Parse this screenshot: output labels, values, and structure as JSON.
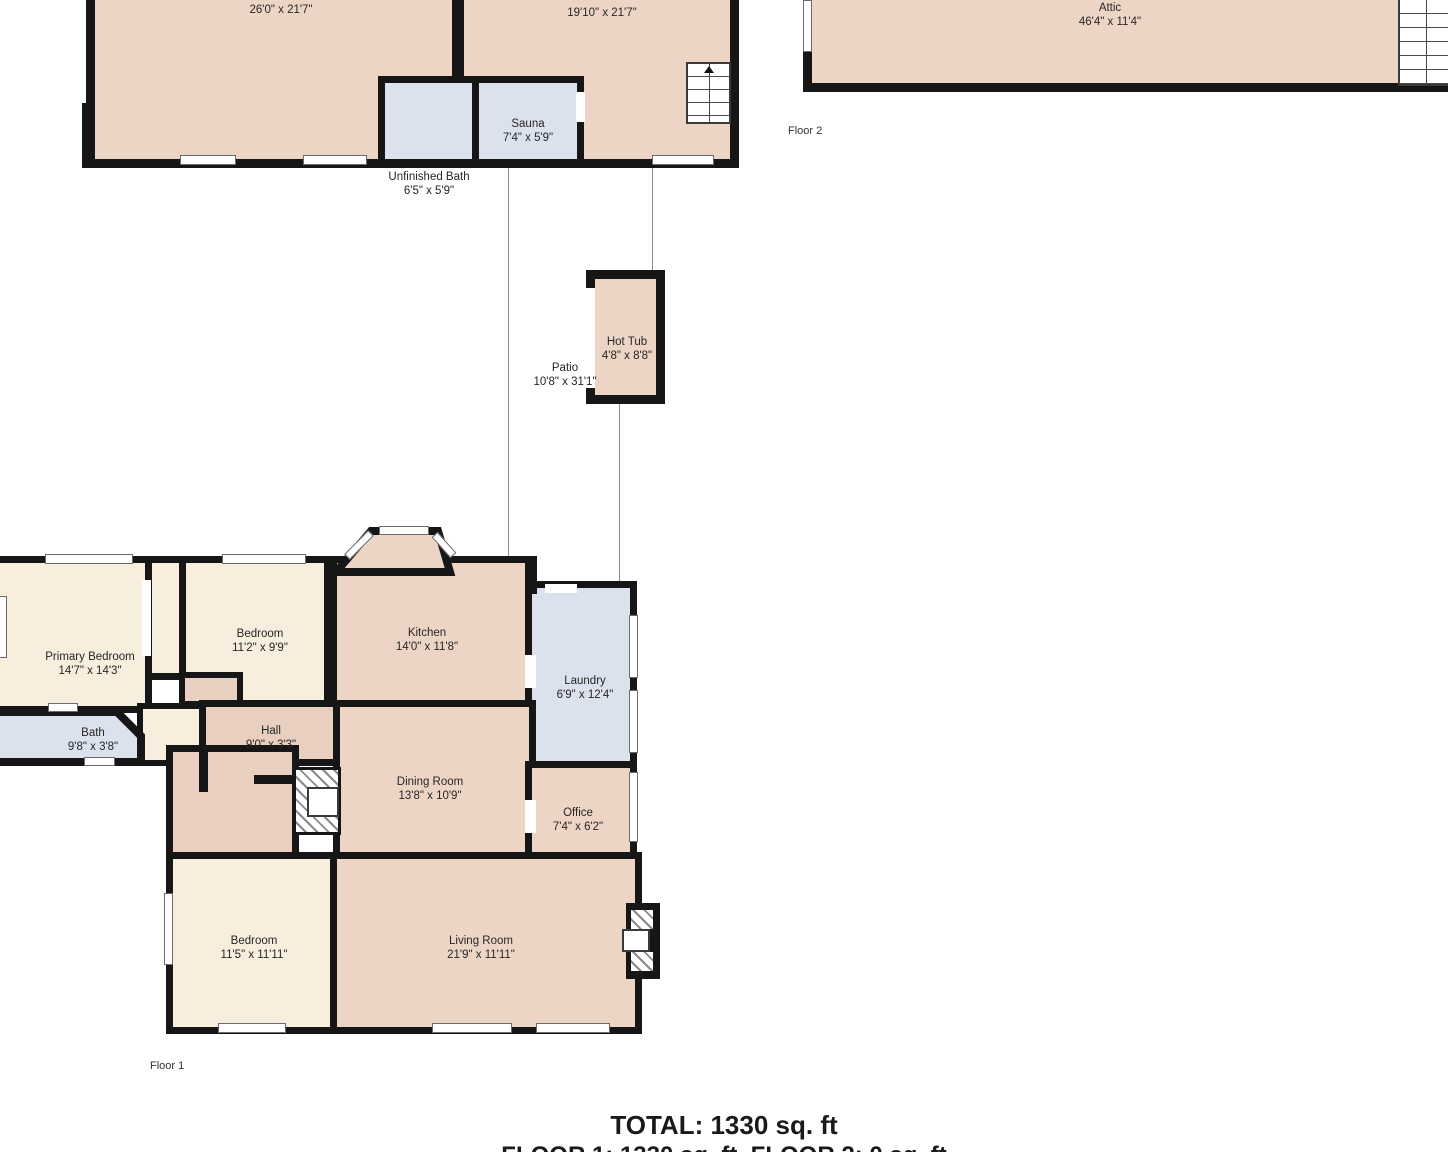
{
  "summary": {
    "total": "TOTAL: 1330 sq. ft",
    "floors": "FLOOR 1: 1330 sq. ft, FLOOR 2: 0 sq. ft"
  },
  "floor_tags": {
    "floor1": "Floor 1",
    "floor2": "Floor 2"
  },
  "colors": {
    "wall": "#161616",
    "room_pink": "#edd5c6",
    "room_cream": "#f8eedd",
    "room_tan": "#e8cfc0",
    "room_blue": "#dbe1ed",
    "background": "#ffffff"
  },
  "rooms": {
    "basement_left": {
      "dims": "26'0\" x 21'7\""
    },
    "basement_right": {
      "dims": "19'10\" x 21'7\""
    },
    "sauna": {
      "name": "Sauna",
      "dims": "7'4\" x 5'9\""
    },
    "unfinished_bath": {
      "name": "Unfinished Bath",
      "dims": "6'5\" x 5'9\""
    },
    "attic": {
      "name": "Attic",
      "dims": "46'4\" x 11'4\""
    },
    "hot_tub": {
      "name": "Hot Tub",
      "dims": "4'8\" x 8'8\""
    },
    "patio": {
      "name": "Patio",
      "dims": "10'8\" x 31'1\""
    },
    "primary_bedroom": {
      "name": "Primary Bedroom",
      "dims": "14'7\" x 14'3\""
    },
    "bedroom_top": {
      "name": "Bedroom",
      "dims": "11'2\" x 9'9\""
    },
    "kitchen": {
      "name": "Kitchen",
      "dims": "14'0\" x 11'8\""
    },
    "laundry": {
      "name": "Laundry",
      "dims": "6'9\" x 12'4\""
    },
    "bath": {
      "name": "Bath",
      "dims": "9'8\" x 3'8\""
    },
    "hall": {
      "name": "Hall",
      "dims": "9'0\" x 3'3\""
    },
    "dining_room": {
      "name": "Dining Room",
      "dims": "13'8\" x 10'9\""
    },
    "office": {
      "name": "Office",
      "dims": "7'4\" x 6'2\""
    },
    "bedroom_bottom": {
      "name": "Bedroom",
      "dims": "11'5\" x 11'11\""
    },
    "living_room": {
      "name": "Living Room",
      "dims": "21'9\" x 11'11\""
    }
  }
}
